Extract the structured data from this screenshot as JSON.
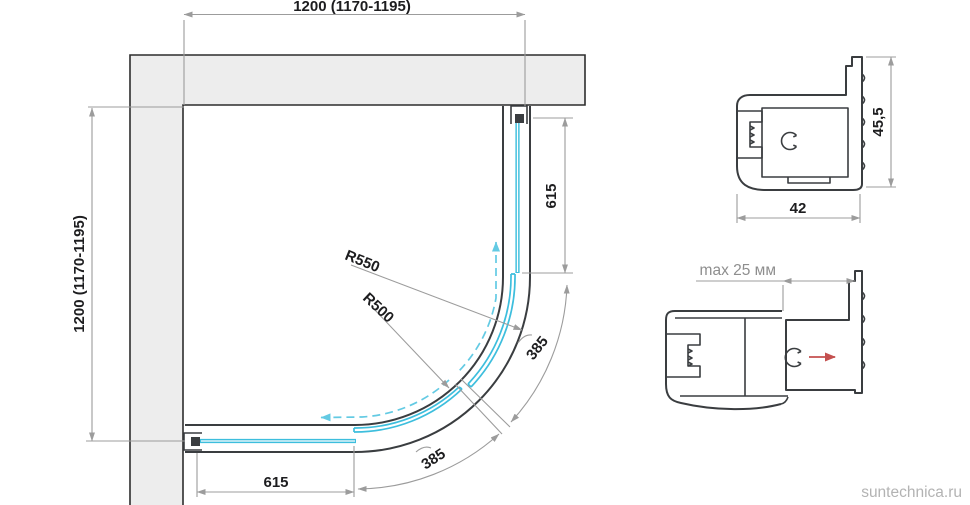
{
  "plan_view": {
    "width_dimension": "1200 (1170-1195)",
    "height_dimension": "1200 (1170-1195)",
    "fixed_panel_right_length": "615",
    "fixed_panel_bottom_length": "615",
    "door_outer_radius": "R550",
    "door_inner_radius": "R500",
    "door_right_arc_length": "385",
    "door_bottom_arc_length": "385"
  },
  "profile_section": {
    "height_dimension": "45,5",
    "width_dimension": "42"
  },
  "adjustment_section": {
    "max_adjustment_label": "max 25 мм"
  },
  "watermark": "suntechnica.ru",
  "colors": {
    "frame": "#3a3d40",
    "wall_fill": "#ededed",
    "wall_border": "#2d2d2d",
    "glass": "#3dbedd",
    "dim": "#9c9c9c",
    "text": "#1d1d1f",
    "muted": "#8e8e8e",
    "accent_red": "#c4504f",
    "watermark": "#b3b3b3"
  }
}
